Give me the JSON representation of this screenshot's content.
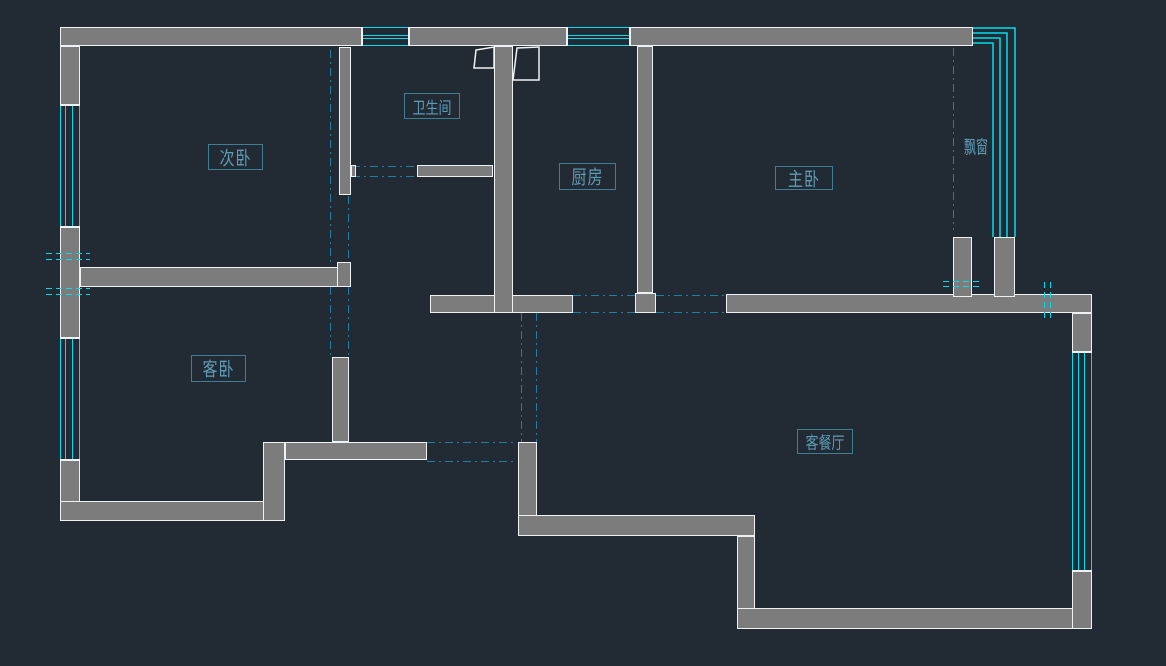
{
  "drawing": {
    "type": "cad-floor-plan",
    "background": "dark"
  },
  "colors": {
    "background": "#222a33",
    "wall_fill": "#7c7c7c",
    "wall_outline": "#eff2f4",
    "window_glass": "#00dcf0",
    "opening_dash": "#1e7ea6",
    "beam_dash": "#00dcf0",
    "label_text": "#5f9cb8",
    "label_border": "#3f7e99"
  },
  "rooms": [
    {
      "id": "second-bedroom",
      "label": "次卧"
    },
    {
      "id": "bathroom",
      "label": "卫生间"
    },
    {
      "id": "kitchen",
      "label": "厨房"
    },
    {
      "id": "master-bedroom",
      "label": "主卧"
    },
    {
      "id": "guest-bedroom",
      "label": "客卧"
    },
    {
      "id": "living-dining-room",
      "label": "客餐厅"
    }
  ],
  "annotations": [
    {
      "id": "bay-window",
      "label": "飘窗"
    }
  ]
}
